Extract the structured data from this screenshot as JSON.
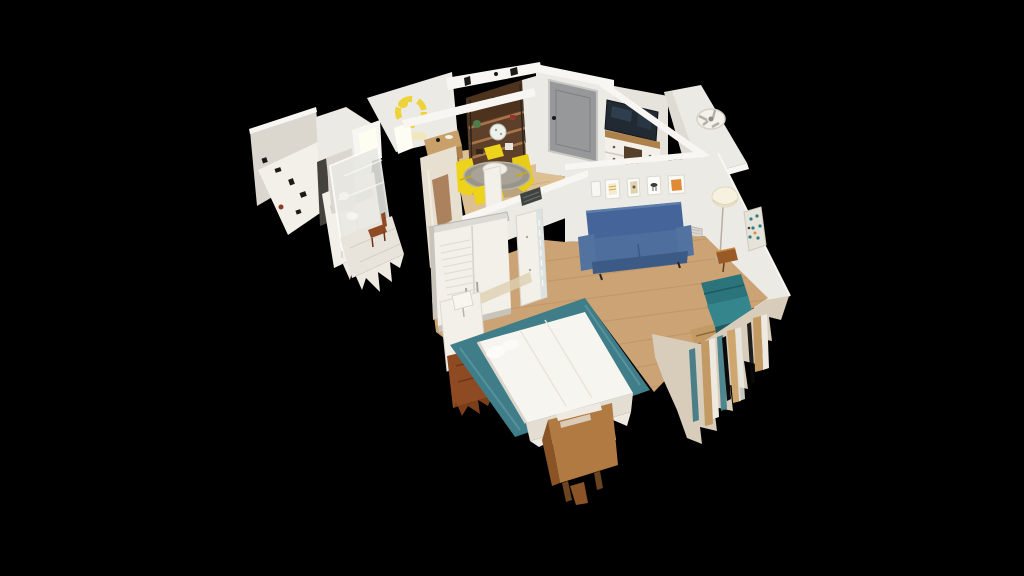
{
  "meta": {
    "view_type": "3d-dollhouse-cutaway",
    "description": "Photogrammetry dollhouse view of a studio apartment floating on a black background, with torn scan-mesh edges"
  },
  "colors": {
    "bg": "#000000",
    "wall": "#eceae4",
    "wallBright": "#f8f6f2",
    "wallShadow": "#dbd7cf",
    "wallDark": "#c9c4bb",
    "floorWood": "#cba375",
    "floorWoodLine": "#b9905f",
    "floorPale": "#dcc093",
    "tile": "#e8e4dc",
    "doorGray": "#97989a",
    "tvScreen": "#212a33",
    "woodTop": "#ad8149",
    "woodMid": "#b07a42",
    "woodDark": "#8a5426",
    "woodRed": "#8e4a22",
    "shelfBrown": "#5e402a",
    "shelfShadow": "#49301c",
    "sofaBlue": "#4e6f9e",
    "sofaBlueMid": "#45659a",
    "sofaBlueDark": "#3c5a86",
    "tealChair": "#2f7e86",
    "tealChairDark": "#1f5a61",
    "rugTeal": "#3f7d89",
    "chairYellow": "#eed31c",
    "artYellow": "#edd23a",
    "artOrange": "#e08a35",
    "lampShade": "#f7f1df",
    "white": "#f2f0e9",
    "tornTan": "#c39a63",
    "tornBase": "#d8ccba",
    "tornLight": "#efeae1",
    "glassGray": "#e9e9e4",
    "speckDark": "#1a1a18",
    "accentRed": "#8e3a2a",
    "plantGreen": "#4e7c4a"
  },
  "scene": {
    "rooms": [
      {
        "id": "kitchen",
        "label": "Kitchen with counter and white cabinets"
      },
      {
        "id": "bathroom",
        "label": "Bathroom with glass shower and wooden chair"
      },
      {
        "id": "dining-nook",
        "label": "Dining nook with round glass table and yellow chairs"
      },
      {
        "id": "entry",
        "label": "Entry with gray front door"
      },
      {
        "id": "media-wall",
        "label": "Media nook with TV on dresser"
      },
      {
        "id": "living-room",
        "label": "Living room with blue sofa, wall art, floor lamp and teal armchair"
      },
      {
        "id": "sleeping-area",
        "label": "Sleeping area with white bed on teal rug, closet and nightstands"
      }
    ],
    "objects": [
      "kitchen-counter",
      "kitchen-cabinets",
      "glass-shower",
      "bathroom-chair",
      "yellow-wreath-wall-art",
      "writing-desk",
      "bookshelf-cart",
      "globe",
      "round-glass-dining-table",
      "yellow-dining-chairs",
      "entry-door",
      "flat-screen-tv",
      "tv-dresser",
      "ceiling-fan",
      "framed-art-set",
      "blue-sleeper-sofa",
      "wall-vent",
      "paper-floor-lamp",
      "speckled-poster",
      "wood-side-table",
      "teal-armchair",
      "louvered-closet-doors",
      "mirror-door",
      "white-dresser-with-lamp",
      "teal-area-rug",
      "white-bed",
      "wood-nightstand",
      "torn-mesh-edges"
    ],
    "model": {
      "label": "Dollhouse 3D model of apartment"
    }
  }
}
